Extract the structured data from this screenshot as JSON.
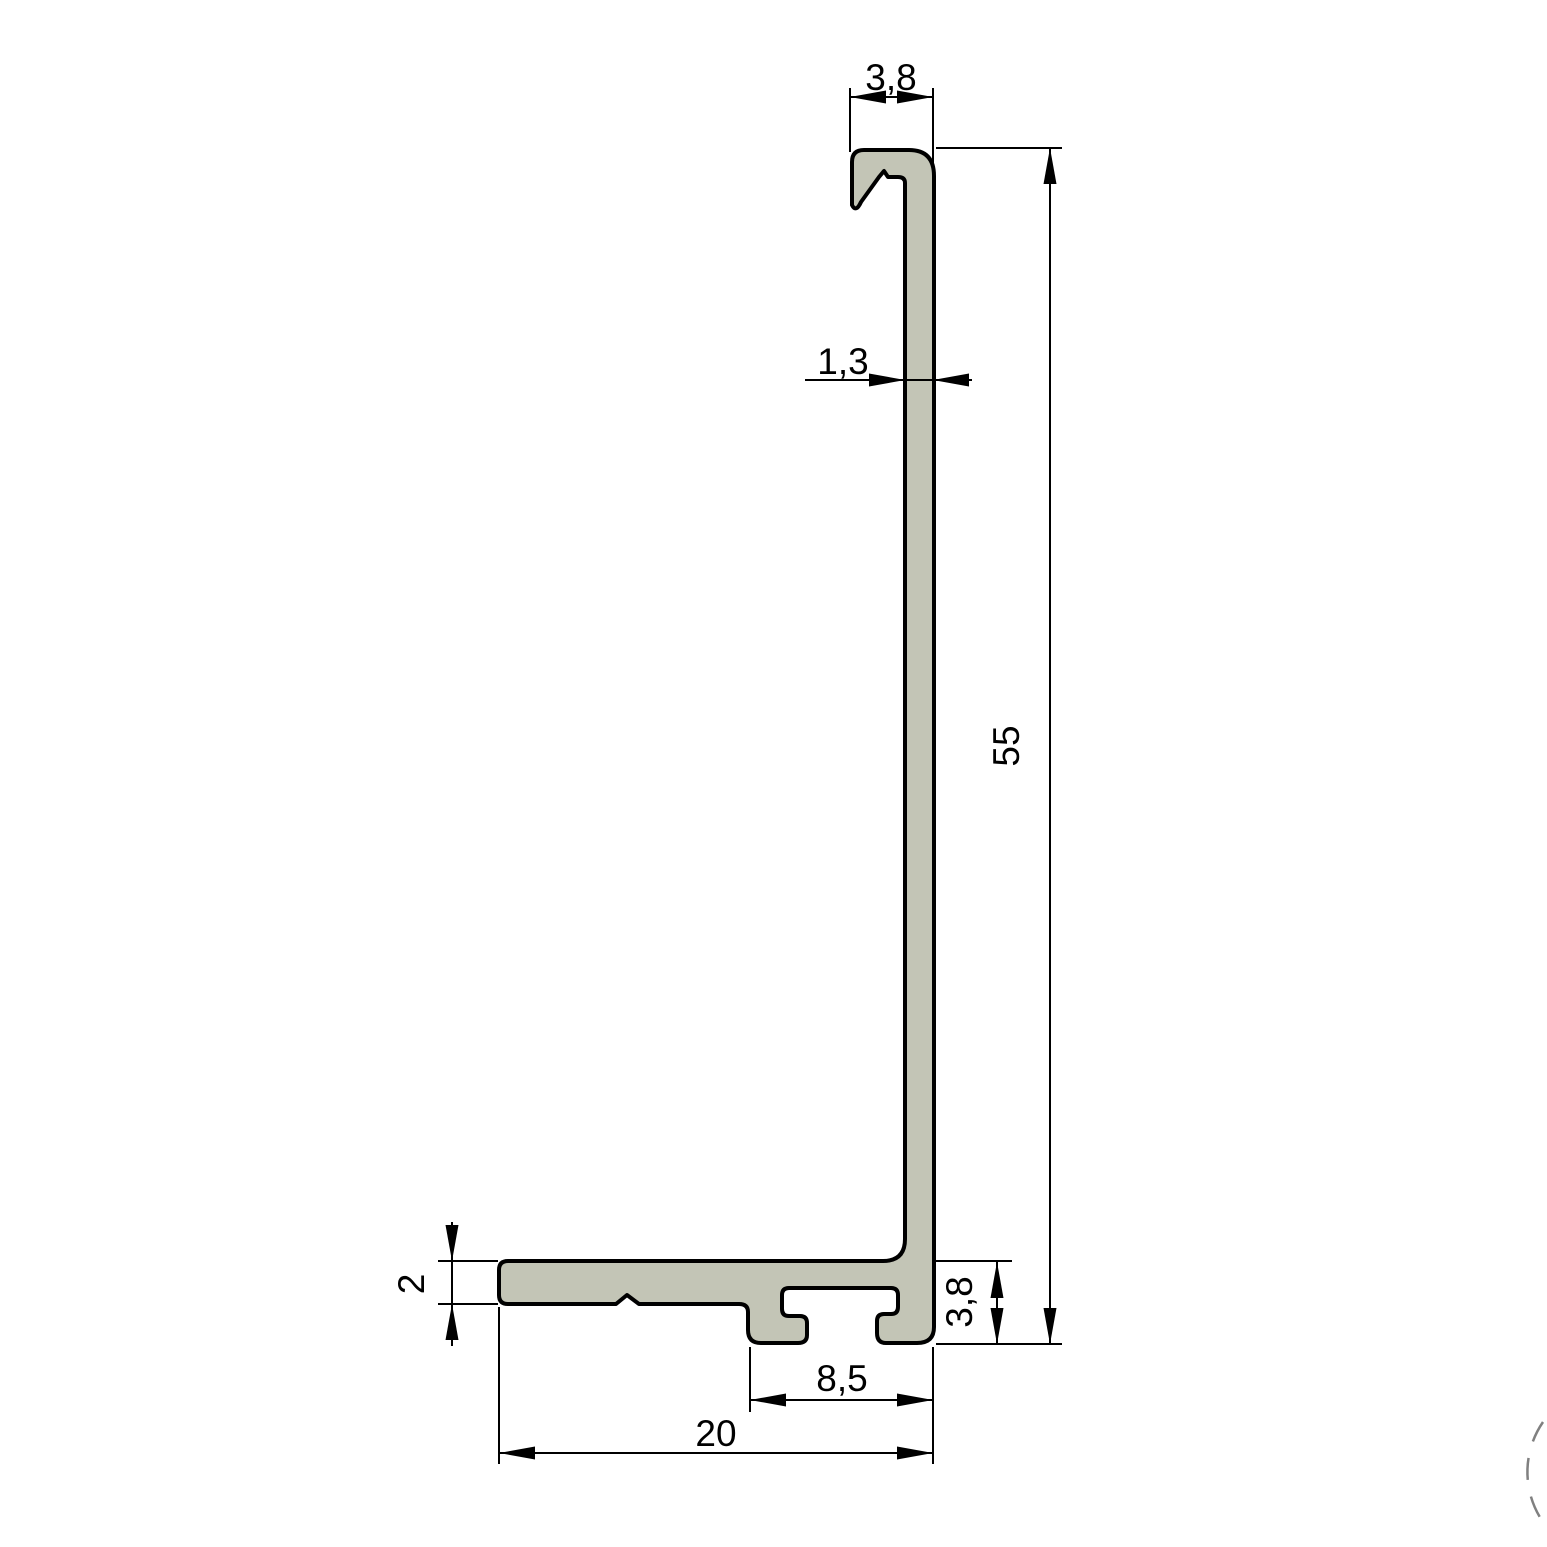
{
  "drawing": {
    "type": "technical-cross-section",
    "subject": "aluminum-extrusion-profile",
    "colors": {
      "background": "#ffffff",
      "profile_fill": "#c3c5b6",
      "outline": "#000000",
      "dimension_line": "#000000",
      "watermark": "#808080"
    },
    "dimensions": {
      "hook_width": "3,8",
      "wall_thickness": "1,3",
      "total_height": "55",
      "flange_thickness": "2",
      "channel_height": "3,8",
      "channel_width": "8,5",
      "total_width": "20"
    }
  }
}
